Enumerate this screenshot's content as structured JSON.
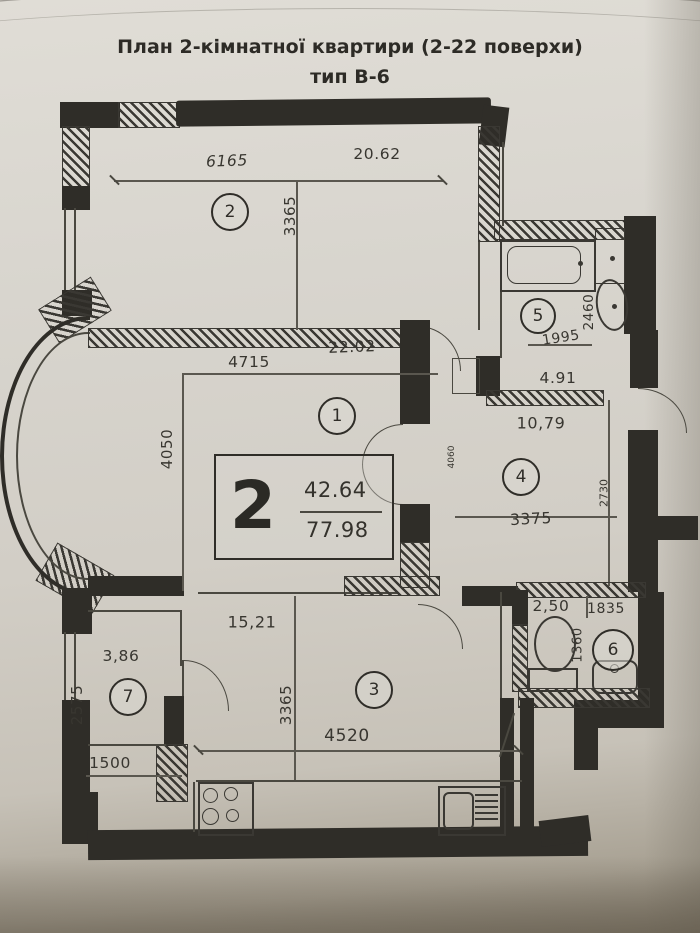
{
  "title": {
    "line1": "План 2-кімнатної квартири (2-22 поверхи)",
    "line2": "тип В-6"
  },
  "summary": {
    "rooms_digit": "2",
    "living_area": "42.64",
    "total_area": "77.98"
  },
  "rooms": [
    {
      "number": "1",
      "area": "22.02",
      "width_mm": "4715",
      "height_mm": "4050"
    },
    {
      "number": "2",
      "area": "20.62",
      "width_mm": "6165",
      "height_mm": "3365"
    },
    {
      "number": "3",
      "area": "15,21",
      "width_mm": "4520",
      "height_mm": "3365"
    },
    {
      "number": "4",
      "area": "10,79",
      "width_mm": "3375",
      "height_mm": "2730"
    },
    {
      "number": "5",
      "area": "4.91",
      "width_mm": "1995",
      "height_mm": "2460"
    },
    {
      "number": "6",
      "area": "2,50",
      "width_mm": "1835",
      "height_mm": "1360"
    },
    {
      "number": "7",
      "area": "3,86",
      "width_mm": "1500",
      "height_mm": "2575"
    }
  ],
  "extra": {
    "small_dim": "4060"
  },
  "fixtures": [
    "bathtub",
    "washbasin",
    "toilet",
    "stove",
    "kitchen-sink"
  ],
  "colors": {
    "paper": "#d8d5ce",
    "ink": "#2f2d28"
  }
}
